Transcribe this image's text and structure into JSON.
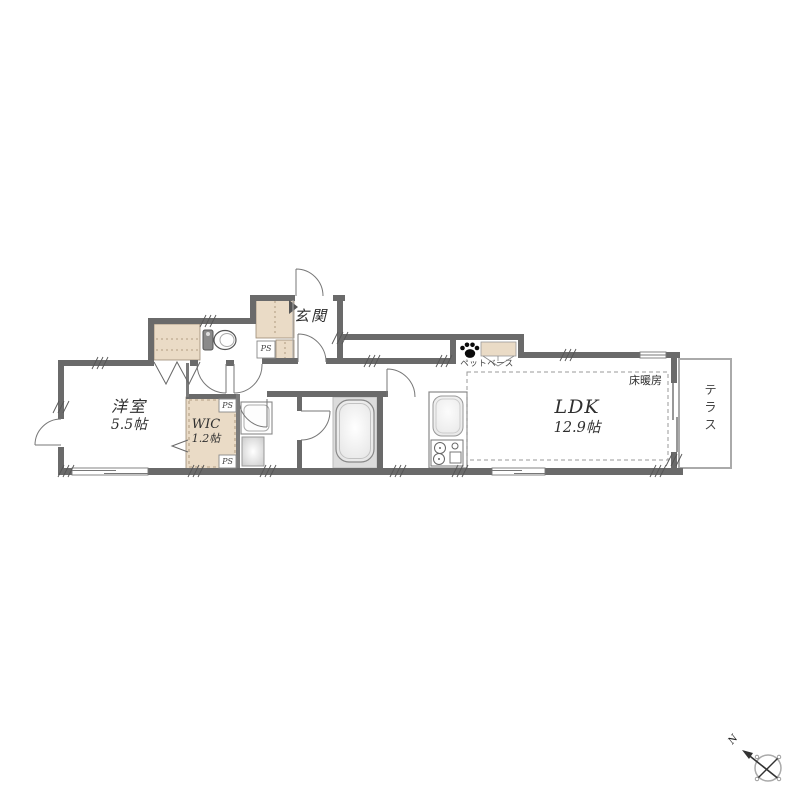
{
  "title": "間取り図",
  "labels": {
    "entrance": "玄関",
    "western_room": "洋室",
    "western_room_size": "5.5帖",
    "wic": "WIC",
    "wic_size": "1.2帖",
    "ldk": "LDK",
    "ldk_size": "12.9帖",
    "floor_heating": "床暖房",
    "terrace": "テラス",
    "pet_space": "ペットベース",
    "pipe_space": "PS",
    "compass_north": "N"
  },
  "colors": {
    "wall": "#6a6a6a",
    "closet_fill": "#eadbc6",
    "bath_floor": "#dcdcdc",
    "outline": "#777777",
    "text": "#333333"
  }
}
